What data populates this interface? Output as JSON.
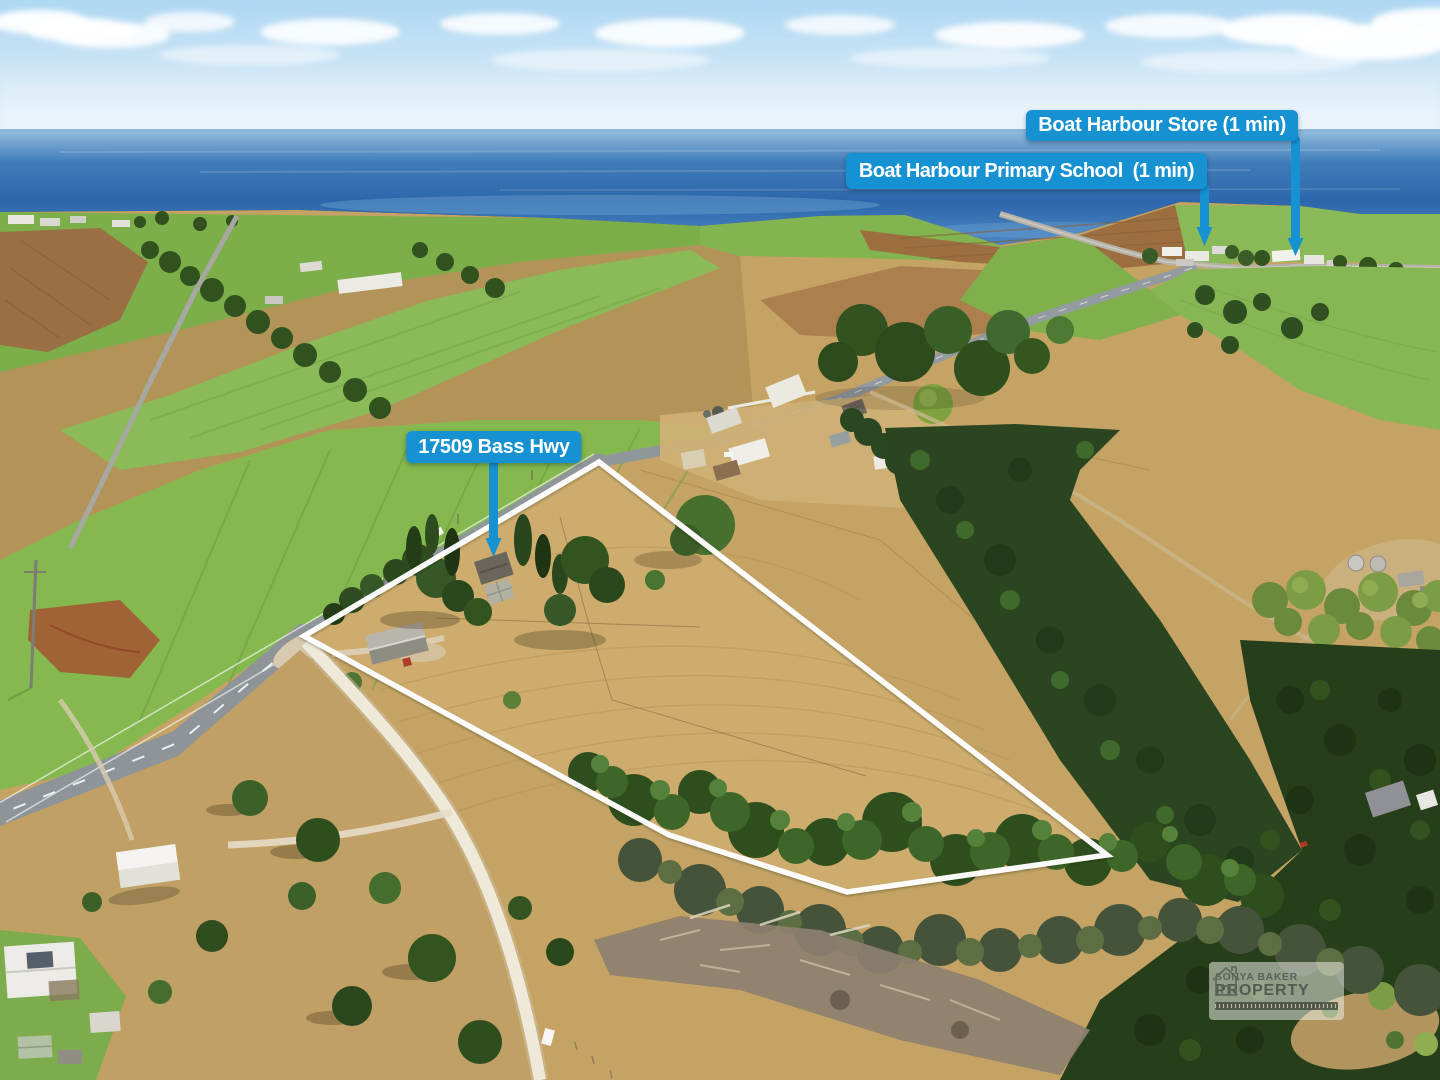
{
  "annotations": {
    "address": {
      "label": "17509 Bass Hwy"
    },
    "school": {
      "label": "Boat Harbour Primary School  (1 min)"
    },
    "store": {
      "label": "Boat Harbour Store (1 min)"
    }
  },
  "watermark": {
    "brand_line1": "SONYA BAKER",
    "brand_line2": "PROPERTY"
  },
  "colors": {
    "annotation_blue": "#1692d2",
    "boundary_white": "#ffffff"
  }
}
